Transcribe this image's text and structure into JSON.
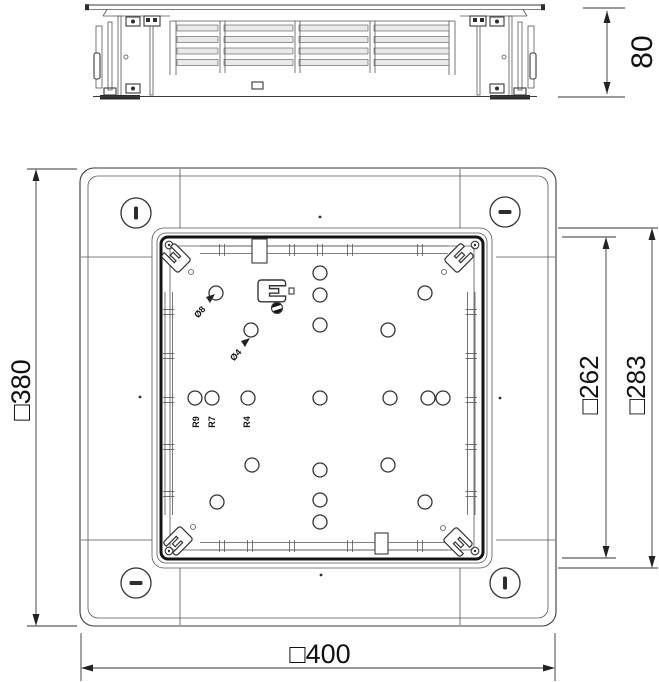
{
  "drawing_title": "Underfloor box technical drawing, side elevation and plan view",
  "colors": {
    "background": "#ffffff",
    "line": "#333333",
    "thick_line": "#141414",
    "dimension_text": "#111111",
    "slat_fill": "#e9e9e9"
  },
  "side_view": {
    "height_dim": "80",
    "slat_rows": [
      25,
      36.5,
      48,
      59.5
    ],
    "slat_segments": [
      [
        177,
        41
      ],
      [
        224,
        69
      ],
      [
        299,
        69
      ],
      [
        374,
        75
      ]
    ],
    "divider_x": [
      220,
      295,
      370
    ]
  },
  "plan_view": {
    "width_dim": "□400",
    "height_dim": "□380",
    "lid_inner_dim": "□262",
    "lid_outer_dim": "□283",
    "radius_labels": [
      "R9",
      "R7",
      "R4"
    ],
    "diameter_labels": [
      "Ø8",
      "Ø4"
    ],
    "holes": [
      [
        320,
        273
      ],
      [
        320,
        295
      ],
      [
        216,
        293
      ],
      [
        425,
        293
      ],
      [
        251,
        330
      ],
      [
        320,
        325
      ],
      [
        388,
        330
      ],
      [
        195,
        398
      ],
      [
        212,
        398
      ],
      [
        248,
        398
      ],
      [
        320,
        398
      ],
      [
        390,
        398
      ],
      [
        428,
        398
      ],
      [
        443,
        398
      ],
      [
        252,
        465
      ],
      [
        320,
        470
      ],
      [
        388,
        465
      ],
      [
        217,
        502
      ],
      [
        320,
        500
      ],
      [
        425,
        502
      ],
      [
        320,
        522
      ]
    ],
    "flange_screws": [
      {
        "x": 136,
        "y": 213,
        "slot": "v"
      },
      {
        "x": 505,
        "y": 212,
        "slot": "h"
      },
      {
        "x": 136,
        "y": 583,
        "slot": "h"
      },
      {
        "x": 505,
        "y": 583,
        "slot": "v"
      }
    ],
    "lid_screws": [
      [
        169,
        245
      ],
      [
        475,
        245
      ],
      [
        169,
        551
      ],
      [
        475,
        551
      ]
    ],
    "center_marks": [
      [
        320,
        217
      ],
      [
        321,
        575
      ],
      [
        140,
        397
      ],
      [
        500,
        398
      ]
    ],
    "top_rail_ticks": [
      222,
      292,
      320,
      350,
      420
    ],
    "bottom_rail_ticks": [
      222,
      250,
      292,
      350,
      420
    ],
    "side_rail_ticks": [
      312,
      356,
      400,
      447,
      494
    ]
  }
}
